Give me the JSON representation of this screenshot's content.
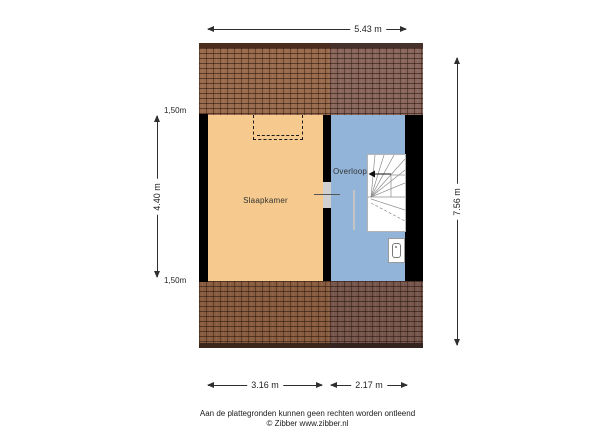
{
  "plan": {
    "rooms": {
      "bedroom": "Slaapkamer",
      "landing": "Overloop"
    }
  },
  "dimensions": {
    "width_total": "5.43 m",
    "height_total": "7.56 m",
    "bedroom_height": "4.40 m",
    "knee_wall_top": "1,50m",
    "knee_wall_bottom": "1,50m",
    "bedroom_width": "3.16 m",
    "landing_width": "2.17 m"
  },
  "footer": {
    "disclaimer": "Aan de plattegronden kunnen geen rechten worden ontleend",
    "credit": "© Zibber www.zibber.nl"
  },
  "colors": {
    "bedroom_floor": "#f6ca8e",
    "landing_floor": "#92b4d9",
    "roof_front_left": "#9a6b4c",
    "roof_front_right": "#8a675c",
    "roof_back_left": "#8a5d40",
    "roof_back_right": "#77574d",
    "wall": "#000000",
    "stairs": "#ffffff"
  }
}
